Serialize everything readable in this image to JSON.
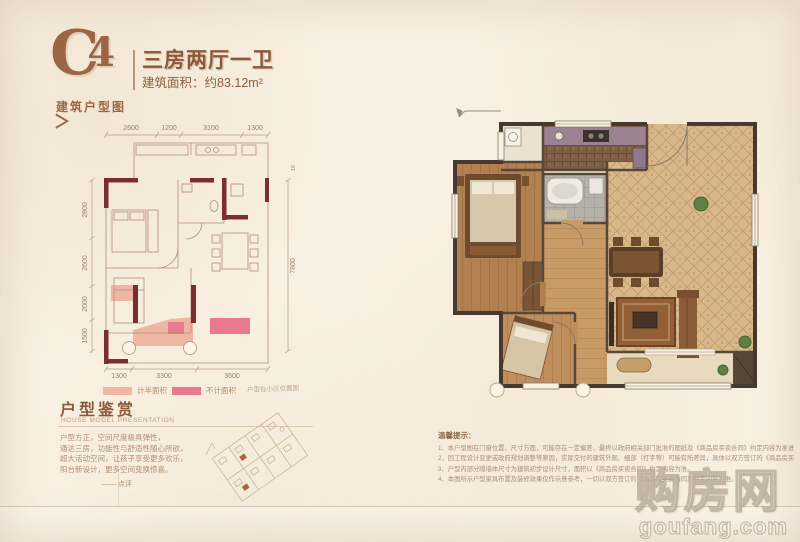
{
  "palette": {
    "background": "#f8f0e2",
    "title_brown": "#9c6644",
    "wall_maroon": "#7b2e30",
    "plan_line": "#b48d75",
    "half_area_pink": "#efb7a3",
    "excluded_pink": "#e87a90",
    "render_wall": "#453931",
    "living_floor": "#d8b88a",
    "kitchen_floor": "#7d5d43",
    "bath_floor": "#b7b2a9",
    "wood_floor": "#b3814f",
    "counter_purple": "#9d8294"
  },
  "header": {
    "unit_code_letter": "C",
    "unit_code_number": "4",
    "unit_title": "三房两厅一卫",
    "area": "建筑面积：约83.12m²"
  },
  "left_plan": {
    "section_label": "建筑户型图",
    "arrow": "＞",
    "dims_top": [
      "2600",
      "1200",
      "3100",
      "1300"
    ],
    "dims_left": [
      "2800",
      "2600",
      "2000",
      "1500"
    ],
    "dim_right": "7800",
    "dim_right_small": "16",
    "dims_bottom": [
      "1300",
      "3300",
      "3600"
    ],
    "legend": [
      {
        "label": "计半面积",
        "color": "#efb7a3"
      },
      {
        "label": "不计面积",
        "color": "#e87a90"
      }
    ],
    "location_caption": "户型在小区位置图"
  },
  "appreciation": {
    "title": "户型鉴赏",
    "subtitle": "HOUSE MODEL PRESENTATION",
    "lines": [
      "户型方正，空间尺度极具弹性，",
      "通达三房，功能性与舒适性随心所欲，",
      "超大活动空间，让孩子享受更多欢乐，",
      "阳台新设计，更多空间变换惊喜。"
    ],
    "signature": "—— 点评"
  },
  "tips": {
    "title": "温馨提示：",
    "items": [
      "1、本户型图在门窗位置、尺寸方面，可能存在一定偏差，最终以政府相关部门批准的图纸及《商品房买卖合同》约定内容为准进行交付。",
      "2、因工程设计变更或政府规划调整等原因，实际交付的建筑外观、细部（打字等）可能有所差异，具体以双方签订的《商品房买卖合同》及其附件约定内容为准。",
      "3、户型内部分隔墙体尺寸为建筑初步设计尺寸，面积以《商品房买卖合同》约定内容为准。",
      "4、本图所示户型家具布置及装修效果仅作示意参考，一切以双方签订的《商品房买卖合同》约定内容为准。"
    ]
  },
  "watermark": {
    "brand": "购房网",
    "domain": "goufang.com"
  }
}
